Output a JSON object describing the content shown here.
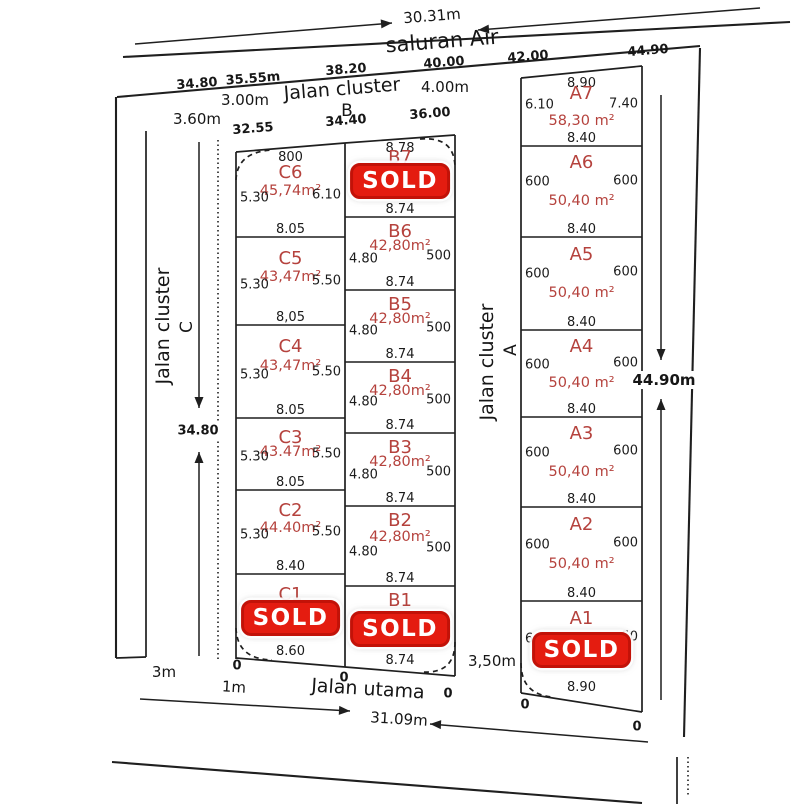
{
  "sold_label": "SOLD",
  "labels": {
    "top_arrow_dim": "30.31m",
    "saluran_air": "saluran Air",
    "top_dims": [
      "34.80",
      "35.55m",
      "38.20",
      "40.00",
      "42.00",
      "44.90"
    ],
    "cluster_b": {
      "name": "Jalan cluster",
      "letter": "B",
      "width_left": "3.00m",
      "width_right": "4.00m"
    },
    "left_width": "3.60m",
    "mid_dims": [
      "32.55",
      "34.40",
      "36.00"
    ],
    "cluster_c": {
      "name": "Jalan cluster",
      "letter": "C",
      "length": "34.80"
    },
    "cluster_a": {
      "name": "Jalan cluster",
      "letter": "A",
      "width_bottom": "3,50m"
    },
    "right_length": "44.90m",
    "jalan_utama": "Jalan utama",
    "bottom_arrow_dim": "31.09m",
    "utama_width": "1m",
    "outer_width": "3m",
    "zero": "0"
  },
  "columns": [
    {
      "id": "C",
      "plots": [
        {
          "name": "C6",
          "top": "800",
          "area": "45,74m²",
          "left": "5.30",
          "right": "6.10",
          "bottom": "8.05",
          "sold": false
        },
        {
          "name": "C5",
          "area": "43,47m²",
          "left": "5.30",
          "right": "5.50",
          "bottom": "8,05",
          "sold": false
        },
        {
          "name": "C4",
          "area": "43,47m²",
          "left": "5.30",
          "right": "5.50",
          "bottom": "8.05",
          "sold": false
        },
        {
          "name": "C3",
          "area": "43.47m²",
          "left": "5.30",
          "right": "5.50",
          "bottom": "8.05",
          "sold": false
        },
        {
          "name": "C2",
          "area": "44.40m²",
          "left": "5.30",
          "right": "5.50",
          "bottom": "8.40",
          "sold": false
        },
        {
          "name": "C1",
          "right": "0",
          "bottom": "8.60",
          "sold": true
        }
      ]
    },
    {
      "id": "B",
      "plots": [
        {
          "name": "B7",
          "top": "8.78",
          "right": "0",
          "bottom": "8.74",
          "sold": true
        },
        {
          "name": "B6",
          "area": "42,80m²",
          "left": "4.80",
          "right": "500",
          "bottom": "8.74",
          "sold": false
        },
        {
          "name": "B5",
          "area": "42,80m²",
          "left": "4.80",
          "right": "500",
          "bottom": "8.74",
          "sold": false
        },
        {
          "name": "B4",
          "area": "42,80m²",
          "left": "4.80",
          "right": "500",
          "bottom": "8.74",
          "sold": false
        },
        {
          "name": "B3",
          "area": "42,80m²",
          "left": "4.80",
          "right": "500",
          "bottom": "8.74",
          "sold": false
        },
        {
          "name": "B2",
          "area": "42,80m²",
          "left": "4.80",
          "right": "500",
          "bottom": "8.74",
          "sold": false
        },
        {
          "name": "B1",
          "right": "0",
          "bottom": "8.74",
          "sold": true
        }
      ]
    },
    {
      "id": "A",
      "plots": [
        {
          "name": "A7",
          "top": "8.90",
          "area": "58,30 m²",
          "left": "6.10",
          "right": "7.40",
          "bottom": "8.40",
          "sold": false
        },
        {
          "name": "A6",
          "area": "50,40 m²",
          "left": "600",
          "right": "600",
          "bottom": "8.40",
          "sold": false
        },
        {
          "name": "A5",
          "area": "50,40 m²",
          "left": "600",
          "right": "600",
          "bottom": "8.40",
          "sold": false
        },
        {
          "name": "A4",
          "area": "50,40 m²",
          "left": "600",
          "right": "600",
          "bottom": "8.40",
          "sold": false
        },
        {
          "name": "A3",
          "area": "50,40 m²",
          "left": "600",
          "right": "600",
          "bottom": "8.40",
          "sold": false
        },
        {
          "name": "A2",
          "area": "50,40 m²",
          "left": "600",
          "right": "600",
          "bottom": "8.40",
          "sold": false
        },
        {
          "name": "A1",
          "left": "6",
          "right": "50",
          "bottom": "8.90",
          "sold": true
        }
      ]
    }
  ]
}
